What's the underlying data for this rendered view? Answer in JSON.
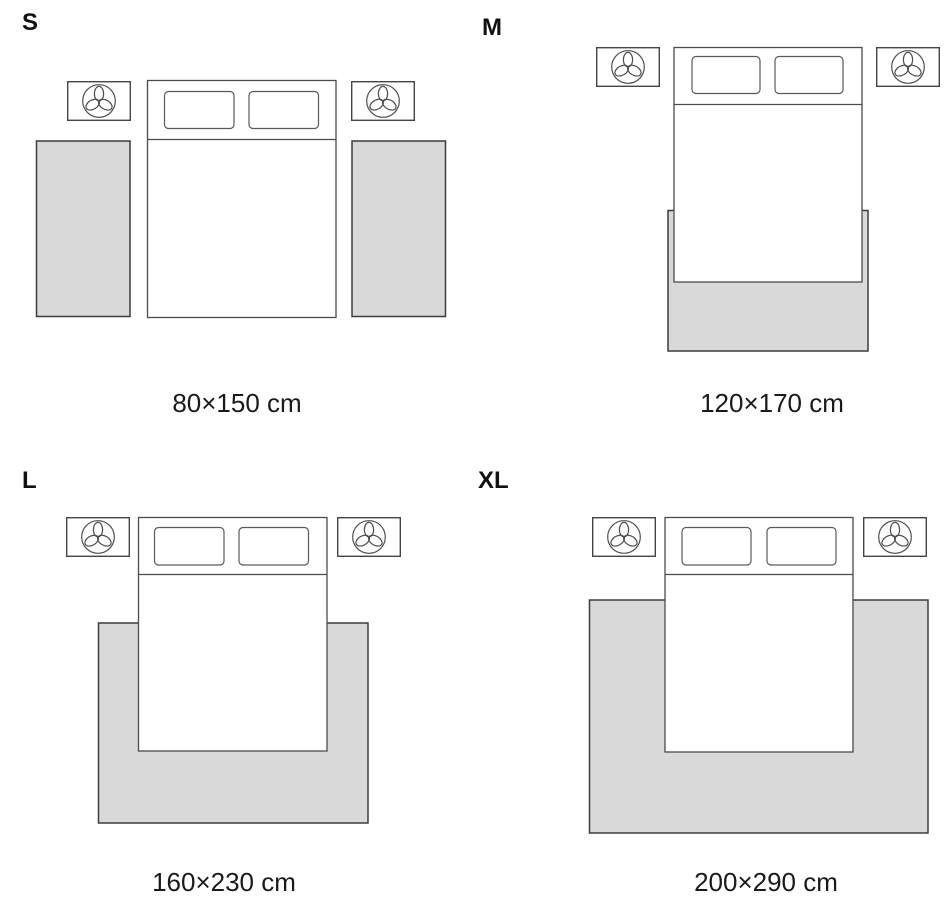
{
  "title": "Rug size guide — bedroom placement diagram",
  "colors": {
    "background": "#ffffff",
    "rug_fill": "#d9d9d9",
    "rug_border": "#3c3c3c",
    "furniture_line": "#4c4c4c",
    "text": "#111111"
  },
  "icons": {
    "nightstand_plant": "plant-icon"
  },
  "sizes": {
    "s": {
      "label": "S",
      "dimensions": "80×150 cm",
      "rug_layout": "two runner rugs, one on each side of the bed"
    },
    "m": {
      "label": "M",
      "dimensions": "120×170 cm",
      "rug_layout": "one rug under the foot of the bed, slightly wider than the bed"
    },
    "l": {
      "label": "L",
      "dimensions": "160×230 cm",
      "rug_layout": "one rug under the lower part of the bed, extending on three sides"
    },
    "xl": {
      "label": "XL",
      "dimensions": "200×290 cm",
      "rug_layout": "one large rug under the bed with a wide surround on three sides"
    }
  }
}
